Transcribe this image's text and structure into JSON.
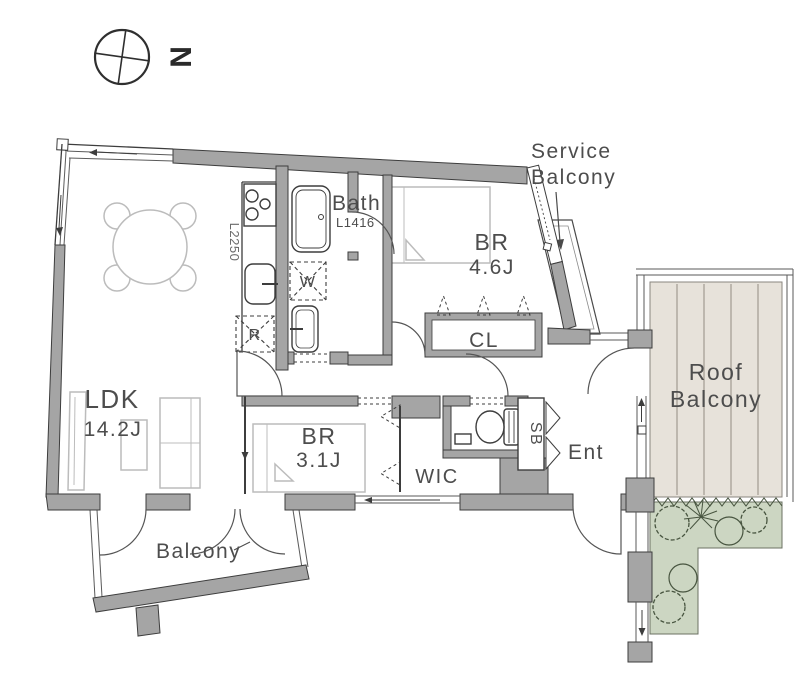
{
  "compass": {
    "north_label": "N"
  },
  "rooms": {
    "ldk": {
      "name": "LDK",
      "area": "14.2J"
    },
    "bedroom1": {
      "name": "BR",
      "area": "4.6J"
    },
    "bedroom2": {
      "name": "BR",
      "area": "3.1J"
    },
    "bath": {
      "name": "Bath",
      "size": "L1416"
    },
    "wic": {
      "name": "WIC"
    },
    "closet": {
      "name": "CL"
    },
    "shoe_box": {
      "name": "SB"
    },
    "entrance": {
      "name": "Ent"
    }
  },
  "kitchen": {
    "counter_length": "L2250",
    "refrigerator_mark": "R",
    "washer_mark": "W"
  },
  "outdoor": {
    "balcony": {
      "name": "Balcony"
    },
    "service_balcony": {
      "line1": "Service",
      "line2": "Balcony"
    },
    "roof_balcony": {
      "line1": "Roof",
      "line2": "Balcony"
    }
  },
  "colors": {
    "wall_gray": "#a5a5a5",
    "outline_dark": "#3d3d3d",
    "furniture_gray": "#bcbcbc",
    "text_gray": "#4d4d4d",
    "deck_beige": "#e7e2da",
    "deck_plank_line": "#bdb7ae",
    "garden_green": "#ccd6c2",
    "plant_outline": "#47543f"
  }
}
